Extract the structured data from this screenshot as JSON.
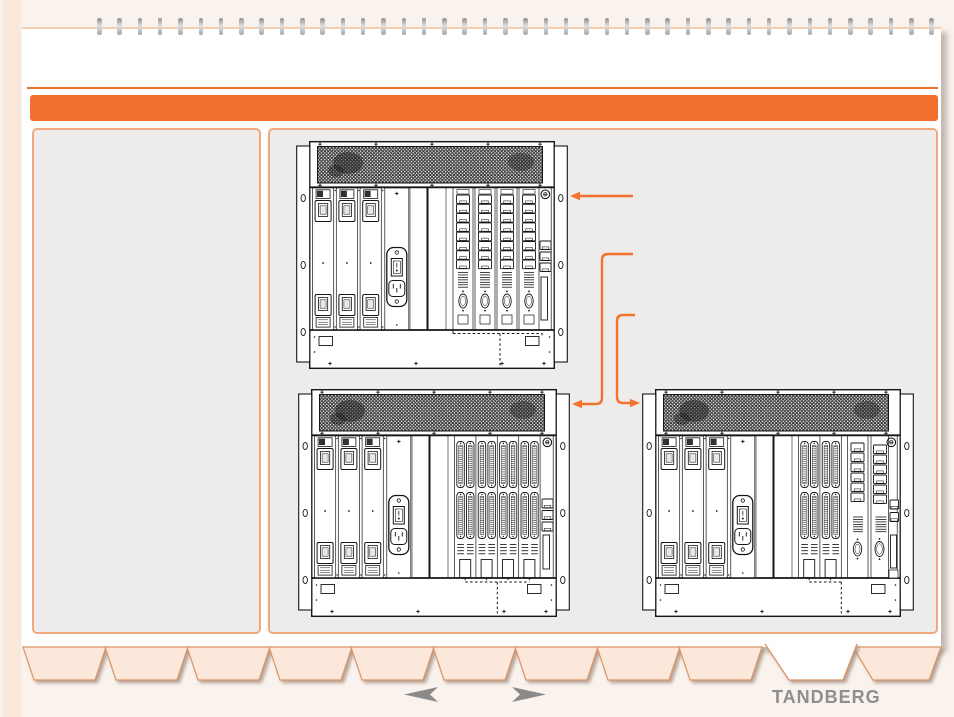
{
  "colors": {
    "canvas_bg": "#faf2ec",
    "page_bg": "#ffffff",
    "page_edge": "#f6cfae",
    "spine_strip": "#f9e8db",
    "accent_bar": "#f2702d",
    "rule": "#e8722c",
    "panel_fill": "#edecea",
    "panel_border": "#f0a87c",
    "tab_fill": "#fce8da",
    "tab_border": "#dd9468",
    "active_tab_fill": "#ffffff",
    "callout": "#f3732e",
    "drawing_ink": "#161616",
    "nav_arrow": "#8a8a8a",
    "logo": "#8f8f8f"
  },
  "binding": {
    "ring_count": 42
  },
  "content": {
    "figures": [
      {
        "name": "rack-chassis-diagram-top",
        "variant": "rj45"
      },
      {
        "name": "rack-chassis-diagram-bottom-left",
        "variant": "dense"
      },
      {
        "name": "rack-chassis-diagram-bottom-right",
        "variant": "mixed"
      }
    ],
    "callouts": [
      {
        "points_to": "rack-chassis-diagram-top",
        "direction": "left"
      },
      {
        "points_to": "rack-chassis-diagram-bottom-left",
        "direction": "left"
      },
      {
        "points_to": "rack-chassis-diagram-bottom-right",
        "direction": "right"
      }
    ]
  },
  "footer": {
    "tabs": [
      {
        "active": false
      },
      {
        "active": false
      },
      {
        "active": false
      },
      {
        "active": false
      },
      {
        "active": false
      },
      {
        "active": false
      },
      {
        "active": false
      },
      {
        "active": false
      },
      {
        "active": false
      },
      {
        "active": true
      },
      {
        "active": false
      }
    ],
    "prev_icon": "left-arrow",
    "next_icon": "right-arrow",
    "logo_text": "TANDBERG"
  }
}
